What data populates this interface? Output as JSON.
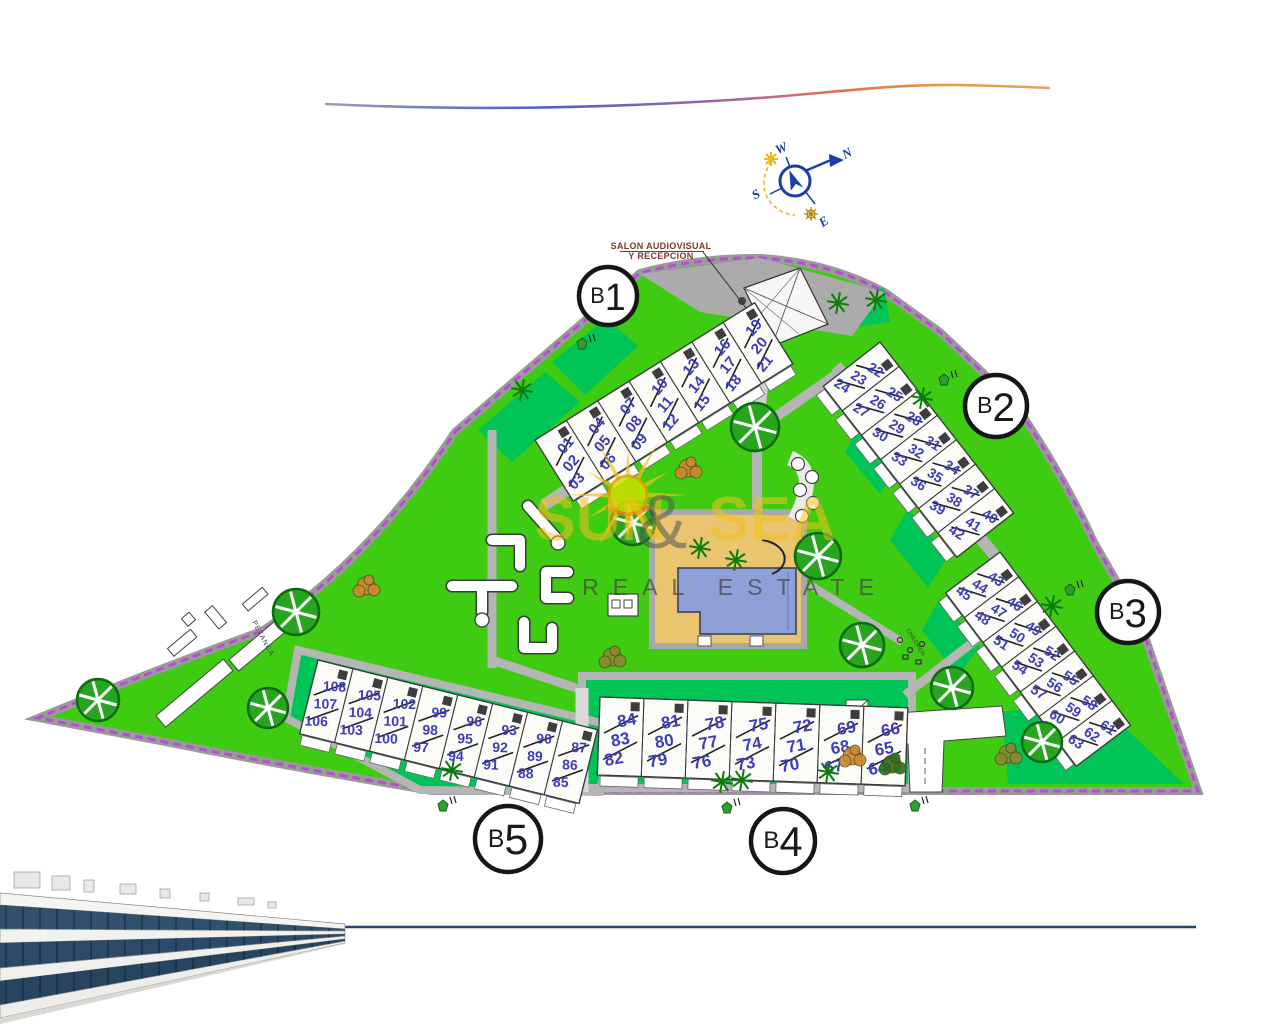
{
  "compass": {
    "n": "N",
    "s": "S",
    "e": "E",
    "w": "W"
  },
  "salon": {
    "line1": "SALON AUDIOVISUAL",
    "line2": "Y RECEPCIÓN"
  },
  "labels": {
    "petanca": "PETANCA",
    "children": "CHILDREN",
    "slope": "Pte. 10%"
  },
  "watermark": {
    "word1": "SUN",
    "amp": "&",
    "word2": "SEA",
    "tagline": "REAL ESTATE"
  },
  "blocks": [
    {
      "id": "B1",
      "badge": "B1",
      "units": [
        [
          "01",
          "02",
          "03"
        ],
        [
          "04",
          "05",
          "06"
        ],
        [
          "07",
          "08",
          "09"
        ],
        [
          "10",
          "11",
          "12"
        ],
        [
          "13",
          "14",
          "15"
        ],
        [
          "16",
          "17",
          "18"
        ],
        [
          "19",
          "20",
          "21"
        ]
      ]
    },
    {
      "id": "B2",
      "badge": "B2",
      "units": [
        [
          "22",
          "23",
          "24"
        ],
        [
          "25",
          "26",
          "27"
        ],
        [
          "28",
          "29",
          "30"
        ],
        [
          "31",
          "32",
          "33"
        ],
        [
          "34",
          "35",
          "36"
        ],
        [
          "37",
          "38",
          "39"
        ],
        [
          "40",
          "41",
          "42"
        ]
      ]
    },
    {
      "id": "B3",
      "badge": "B3",
      "units": [
        [
          "43",
          "44",
          "45"
        ],
        [
          "46",
          "47",
          "48"
        ],
        [
          "49",
          "50",
          "51"
        ],
        [
          "52",
          "53",
          "54"
        ],
        [
          "55",
          "56",
          "57"
        ],
        [
          "58",
          "59",
          "60"
        ],
        [
          "61",
          "62",
          "63"
        ]
      ]
    },
    {
      "id": "B4",
      "badge": "B4",
      "units": [
        [
          "84",
          "83",
          "82"
        ],
        [
          "81",
          "80",
          "79"
        ],
        [
          "78",
          "77",
          "76"
        ],
        [
          "75",
          "74",
          "73"
        ],
        [
          "72",
          "71",
          "70"
        ],
        [
          "69",
          "68",
          "67"
        ],
        [
          "66",
          "65",
          "64"
        ]
      ]
    },
    {
      "id": "B5",
      "badge": "B5",
      "units": [
        [
          "108",
          "107",
          "106"
        ],
        [
          "105",
          "104",
          "103"
        ],
        [
          "102",
          "101",
          "100"
        ],
        [
          "99",
          "98",
          "97"
        ],
        [
          "96",
          "95",
          "94"
        ],
        [
          "93",
          "92",
          "91"
        ],
        [
          "90",
          "89",
          "88"
        ],
        [
          "87",
          "86",
          "85"
        ]
      ]
    }
  ],
  "colors": {
    "lawn": "#3ecb12",
    "hedge": "#00c556",
    "path": "#b5b5b5",
    "plaza": "#ababab",
    "boundary": "#b44fd4",
    "unit_number": "#3d3db8",
    "pool_water": "#8f9fd8",
    "pool_deck": "#eac46f",
    "compass": "#1b3fa8",
    "watermark_yellow": "#f2c11c",
    "salon_text": "#7a3a28",
    "bottom_line": "#26456e",
    "road_white": "#ffffff",
    "tree_green": "#28a51e"
  }
}
